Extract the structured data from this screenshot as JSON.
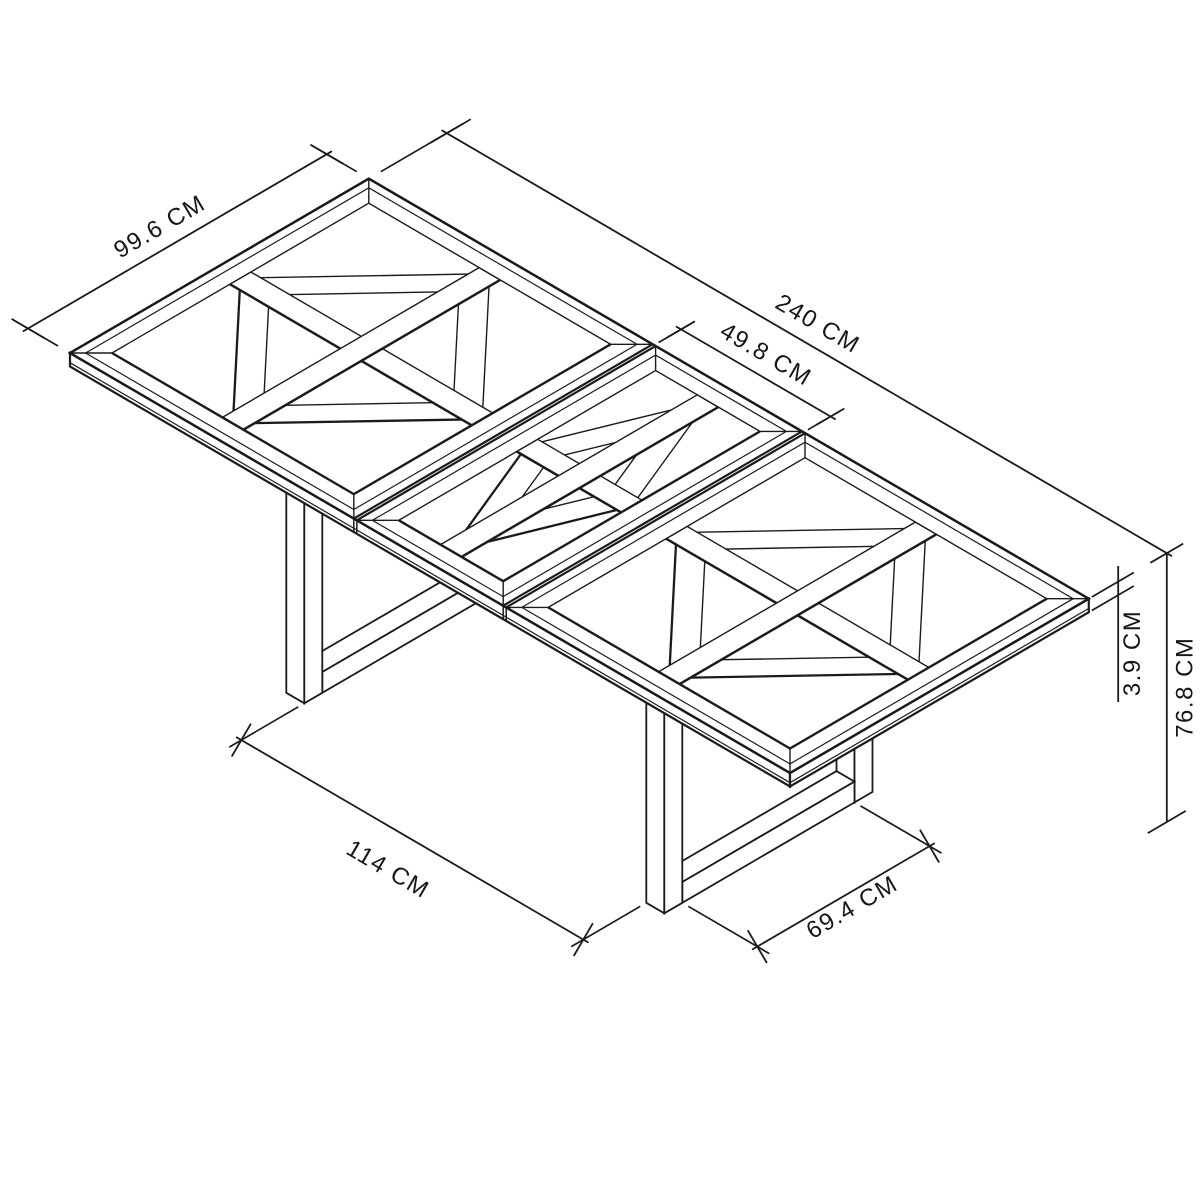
{
  "diagram": {
    "type": "isometric-furniture-dimension-drawing",
    "subject": "Extending parquet-top dining table with U-frame end legs, three top panels (two main panels and centre extension leaf)",
    "unit": "CM",
    "labels": {
      "width": "99.6 CM",
      "length": "240 CM",
      "leaf_width": "49.8 CM",
      "top_thickness": "3.9 CM",
      "height": "76.8 CM",
      "leg_clearance": "114 CM",
      "leg_frame_inner_width": "69.4 CM"
    },
    "measurements_cm": {
      "length": 240,
      "width": 99.6,
      "leaf_width": 49.8,
      "top_thickness": 3.9,
      "height": 76.8,
      "leg_clearance": 114,
      "leg_frame_inner_width": 69.4
    }
  },
  "colors": {
    "line": "#1b1b1b",
    "dimension_line": "#1a1a1a",
    "background": "#ffffff",
    "text": "#161616"
  }
}
